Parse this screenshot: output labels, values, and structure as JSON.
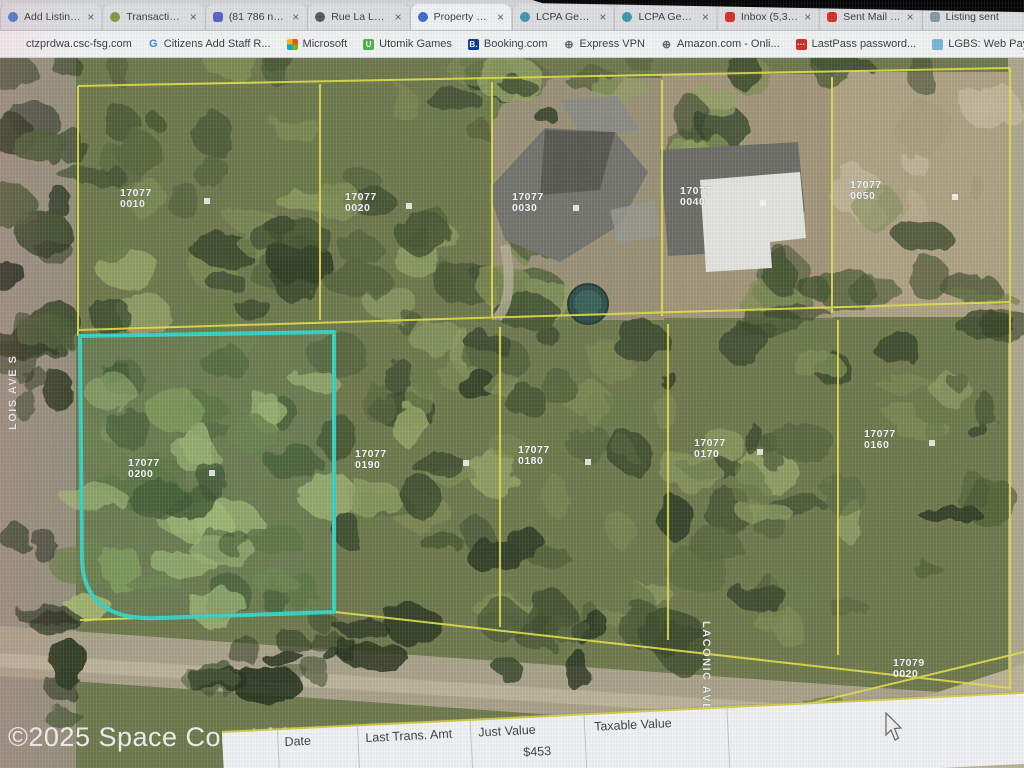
{
  "browser": {
    "tabs": [
      {
        "label": "Add Listing | fl...",
        "icon": "listing-icon",
        "close": "×"
      },
      {
        "label": "Transaction | F...",
        "icon": "transaction-icon",
        "close": "×"
      },
      {
        "label": "(81 786 non lu...",
        "icon": "mail-icon",
        "close": "×"
      },
      {
        "label": "Rue La La — C...",
        "icon": "shopping-icon",
        "close": "×"
      },
      {
        "label": "Property Data",
        "icon": "pinwheel-icon",
        "close": "×",
        "active": true
      },
      {
        "label": "LCPA Geo View",
        "icon": "globe-teal-icon",
        "close": "×"
      },
      {
        "label": "LCPA Geo View",
        "icon": "globe-teal-icon",
        "close": "×"
      },
      {
        "label": "Inbox (5,379)",
        "icon": "gmail-icon",
        "close": "×"
      },
      {
        "label": "Sent Mail - m...",
        "icon": "gmail-icon",
        "close": "×"
      },
      {
        "label": "Listing sent",
        "icon": "mail-gray-icon",
        "close": ""
      }
    ],
    "bookmarks": [
      {
        "label": "ctzprdwa.csc-fsg.com",
        "icon": "globe-icon",
        "glyph": ""
      },
      {
        "label": "Citizens Add Staff R...",
        "icon": "google-g-icon",
        "glyph": "G"
      },
      {
        "label": "Microsoft",
        "icon": "microsoft-icon",
        "glyph": ""
      },
      {
        "label": "Utomik Games",
        "icon": "utomik-icon",
        "glyph": "U"
      },
      {
        "label": "Booking.com",
        "icon": "booking-icon",
        "glyph": "B."
      },
      {
        "label": "Express VPN",
        "icon": "globe-icon",
        "glyph": "⊕"
      },
      {
        "label": "Amazon.com - Onli...",
        "icon": "globe-icon",
        "glyph": "⊕"
      },
      {
        "label": "LastPass password...",
        "icon": "lastpass-icon",
        "glyph": "···"
      },
      {
        "label": "LGBS: Web Payments",
        "icon": "lgbs-icon",
        "glyph": ""
      },
      {
        "label": "OBiTALK: OBi202",
        "icon": "obitalk-icon",
        "glyph": "O"
      },
      {
        "label": "VacantLand...",
        "icon": "vacantland-icon",
        "glyph": ""
      }
    ]
  },
  "map": {
    "watermark": "©2025 Space Coast MLS",
    "parcel_line_color": "#e7e43e",
    "highlight_color": "#2ed8c8",
    "streets": [
      {
        "name": "LOIS AVE S",
        "x": 16,
        "y": 430,
        "rotate": -90
      },
      {
        "name": "LACONIC AVE S",
        "x": 703,
        "y": 621,
        "rotate": 90
      }
    ],
    "parcels": [
      {
        "apn": "17077",
        "lot": "0010",
        "x": 120,
        "y": 196
      },
      {
        "apn": "17077",
        "lot": "0020",
        "x": 345,
        "y": 200
      },
      {
        "apn": "17077",
        "lot": "0030",
        "x": 512,
        "y": 200
      },
      {
        "apn": "17077",
        "lot": "0040",
        "x": 680,
        "y": 194
      },
      {
        "apn": "17077",
        "lot": "0050",
        "x": 850,
        "y": 188
      },
      {
        "apn": "17077",
        "lot": "0200",
        "x": 128,
        "y": 466
      },
      {
        "apn": "17077",
        "lot": "0190",
        "x": 355,
        "y": 457
      },
      {
        "apn": "17077",
        "lot": "0180",
        "x": 518,
        "y": 453
      },
      {
        "apn": "17077",
        "lot": "0170",
        "x": 694,
        "y": 446
      },
      {
        "apn": "17077",
        "lot": "0160",
        "x": 864,
        "y": 437
      },
      {
        "apn": "17079",
        "lot": "0020",
        "x": 893,
        "y": 666
      }
    ]
  },
  "table": {
    "headers": [
      "Date",
      "Last Trans. Amt",
      "Just Value",
      "Taxable Value"
    ],
    "partial_value": "$453"
  }
}
